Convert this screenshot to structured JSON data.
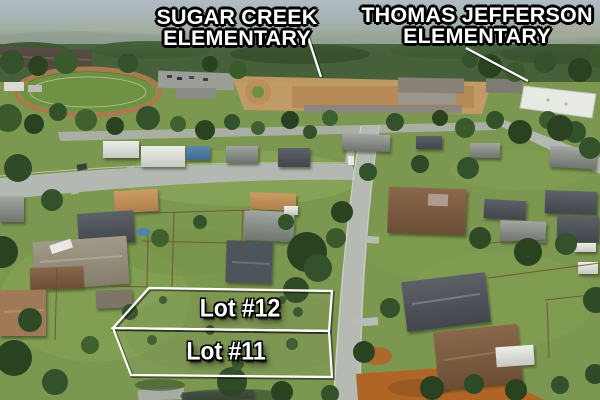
{
  "callouts": {
    "sugar_creek": {
      "line1": "SUGAR CREEK",
      "line2": "ELEMENTARY"
    },
    "thomas_jefferson": {
      "line1": "THOMAS JEFFERSON",
      "line2": "ELEMENTARY"
    }
  },
  "lots": [
    {
      "label": "Lot #12"
    },
    {
      "label": "Lot #11"
    }
  ],
  "colors": {
    "callout_text": "#ffffff",
    "callout_outline": "#000000",
    "lot_line": "#ffffff",
    "lot_text": "#ffffff",
    "pointer_line": "#ffffff"
  }
}
